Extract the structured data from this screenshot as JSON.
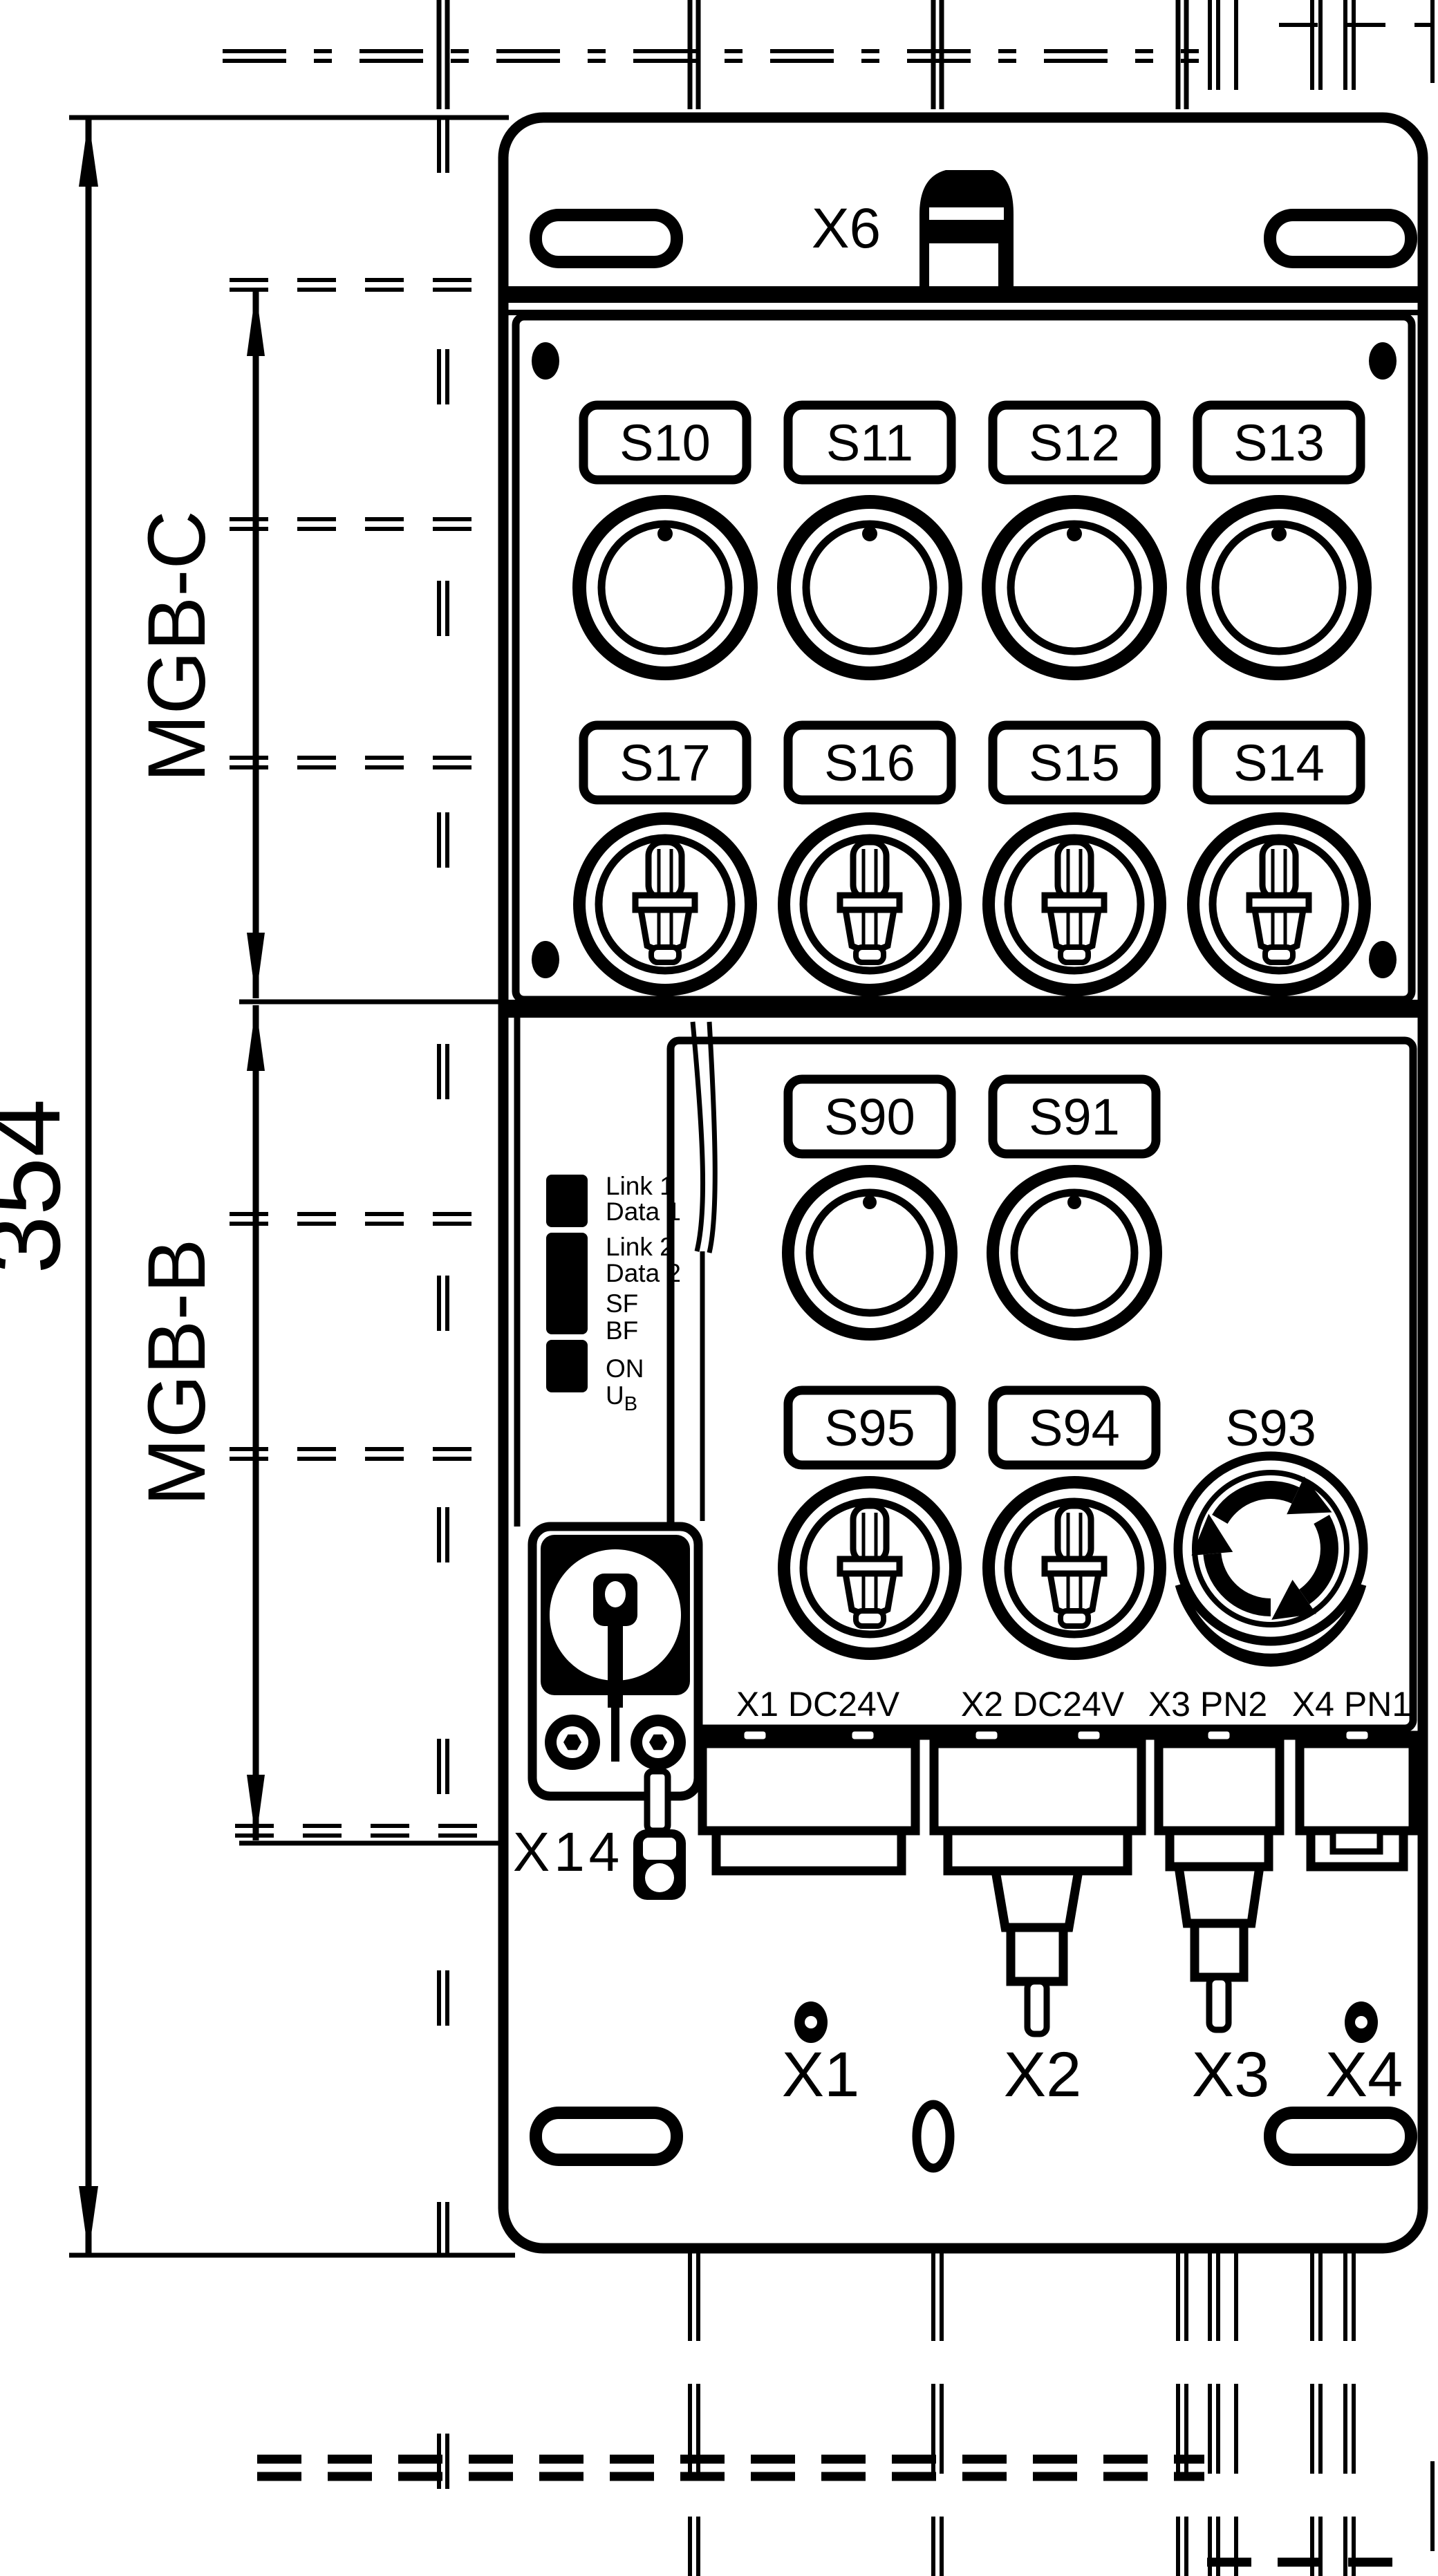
{
  "drawing": {
    "type": "technical-dimension-drawing",
    "colors": {
      "ink": "#000000",
      "paper": "#ffffff"
    }
  },
  "dimensions": {
    "overall_height": "354",
    "section_top": "MGB-C",
    "section_bottom": "MGB-B"
  },
  "top": {
    "connector_label": "X6"
  },
  "mgb_c": {
    "plates_row1": [
      "S10",
      "S11",
      "S12",
      "S13"
    ],
    "plates_row2": [
      "S17",
      "S16",
      "S15",
      "S14"
    ]
  },
  "mgb_b": {
    "plates_row1": [
      "S90",
      "S91"
    ],
    "plates_row2": [
      "S95",
      "S94"
    ],
    "estop_label": "S93",
    "leds": [
      "Link 1",
      "Data 1",
      "Link 2",
      "Data 2",
      "SF",
      "BF",
      "ON"
    ],
    "led_ub": {
      "main": "U",
      "sub": "B"
    },
    "lock_label": "X14"
  },
  "connectors": {
    "ports": [
      "X1 DC24V",
      "X2 DC24V",
      "X3 PN2",
      "X4 PN1"
    ],
    "plugs": [
      "X1",
      "X2",
      "X3",
      "X4"
    ]
  }
}
